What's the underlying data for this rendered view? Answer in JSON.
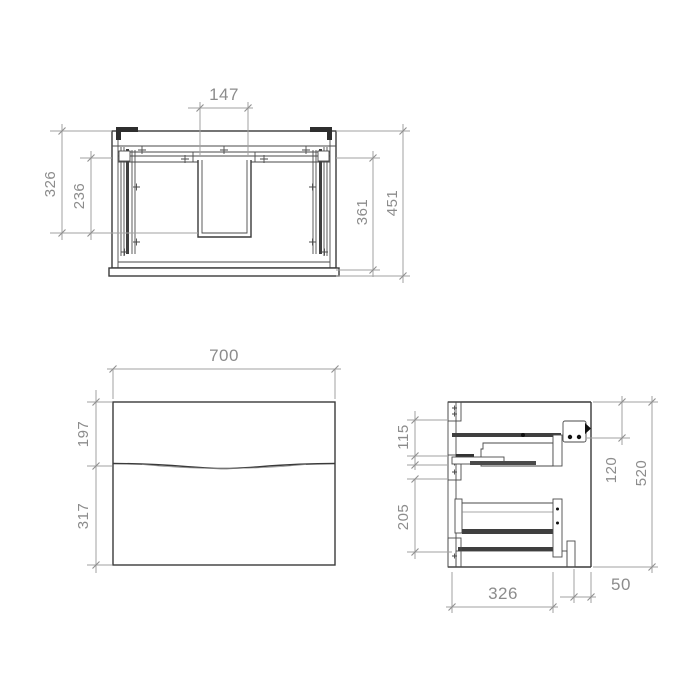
{
  "drawing": {
    "plan": {
      "cutout_width": "147",
      "front_to_back_outer": "326",
      "front_to_back_inner": "236",
      "inner_depth": "361",
      "overall_depth": "451"
    },
    "front": {
      "overall_width": "700",
      "top_drawer_height": "197",
      "bottom_drawer_height": "317"
    },
    "side": {
      "top_section_height": "115",
      "bottom_section_height": "205",
      "bracket_offset": "120",
      "overall_height": "520",
      "drawer_depth": "326",
      "wall_clearance": "50"
    }
  },
  "colors": {
    "outline": "#3a3a3a",
    "dimension_line": "#a2a2a2",
    "dimension_text": "#8c8c8c",
    "background": "#ffffff"
  }
}
